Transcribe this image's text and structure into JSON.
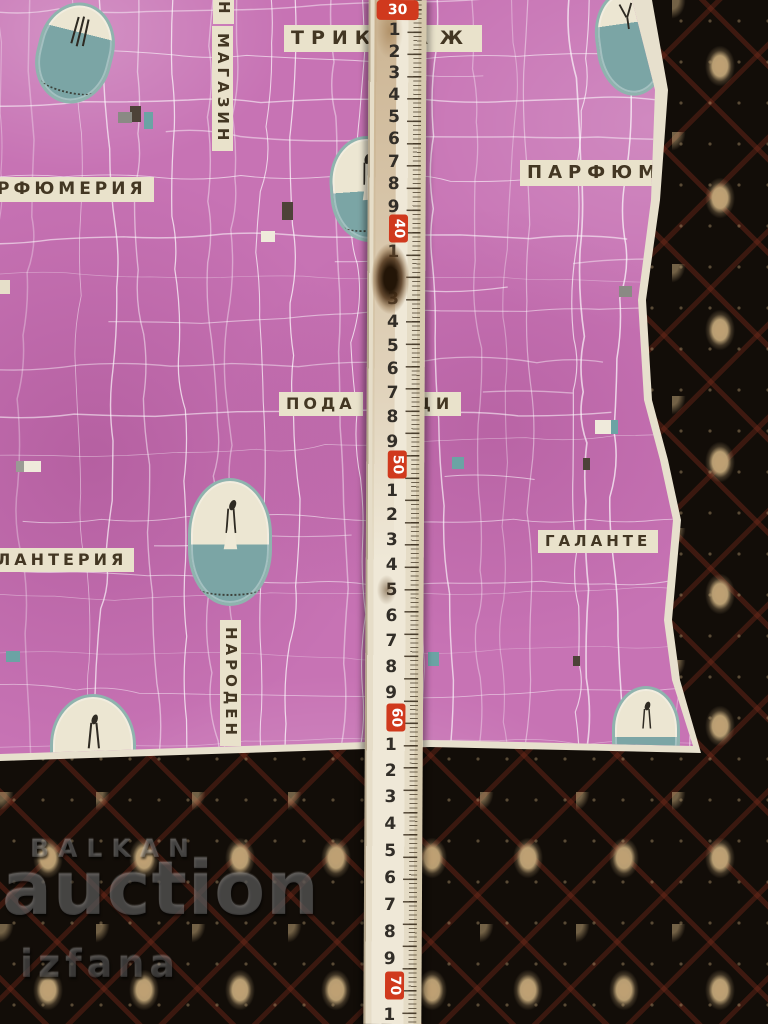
{
  "paper_labels": {
    "trikotazh_left": "ТРИК",
    "trikotazh_right": "АЖ",
    "magazin_partial": "Н",
    "magazin": "МАГАЗИН",
    "parfumeria": "РФЮМЕРИЯ",
    "parfum": "ПАРФЮМ",
    "podartsi_left": "ПОДА",
    "podartsi_right": "ЦИ",
    "galante": "ГАЛАНТЕ",
    "lanteria": "ЛАНТЕРИЯ",
    "naroden": "НАРОДЕН"
  },
  "ruler": {
    "numbers": [
      "30",
      "1",
      "2",
      "3",
      "4",
      "5",
      "6",
      "7",
      "8",
      "9",
      "40",
      "1",
      "2",
      "3",
      "4",
      "5",
      "6",
      "7",
      "8",
      "9",
      "50",
      "1",
      "2",
      "3",
      "4",
      "5",
      "6",
      "7",
      "8",
      "9",
      "60",
      "1",
      "2",
      "3",
      "4",
      "5",
      "6",
      "7",
      "8",
      "9",
      "70",
      "1"
    ]
  },
  "watermark": {
    "line1": "BALKAN",
    "line2": "auction",
    "line3": "izfana"
  },
  "colors": {
    "paper_pink": "#c773b4",
    "label_cream": "#e9e2cb",
    "label_text": "#433723",
    "badge_teal": "#7ba5a5",
    "ruler_red": "#d0391d",
    "carpet_dark": "#120d08"
  }
}
